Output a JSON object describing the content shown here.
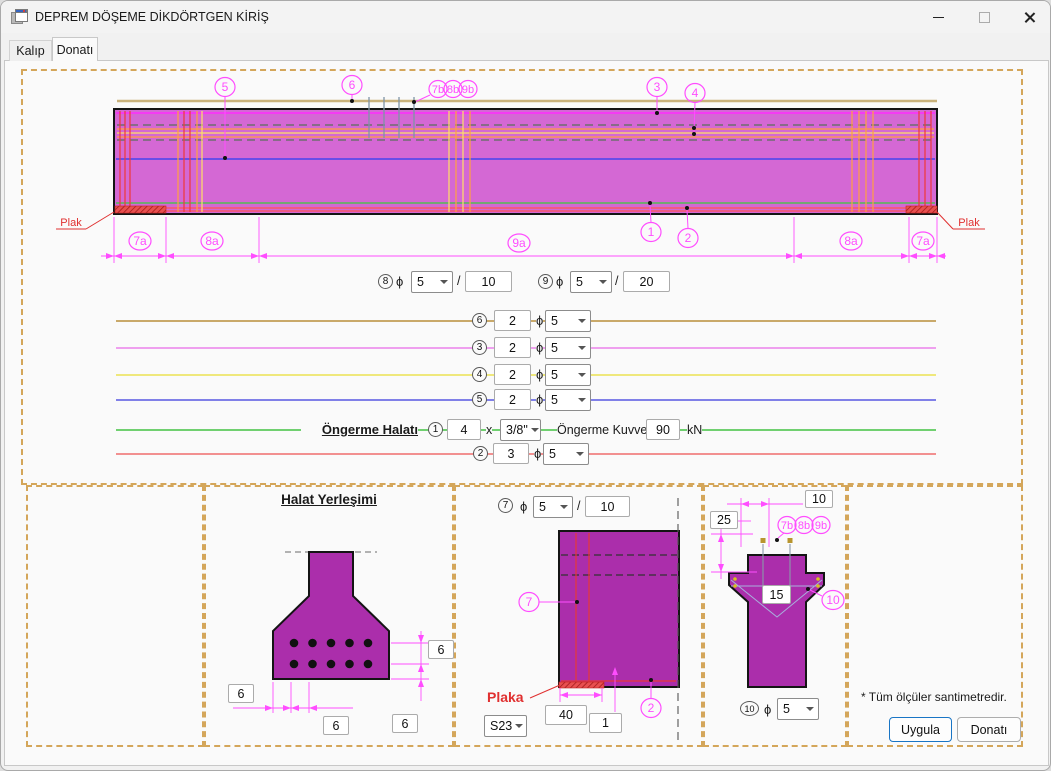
{
  "window": {
    "title": "DEPREM DÖŞEME DİKDÖRTGEN KİRİŞ"
  },
  "tabs": {
    "kalip": "Kalıp",
    "donati": "Donatı"
  },
  "misc": {
    "phi": "ϕ",
    "slash": "/",
    "times": "x"
  },
  "callouts": {
    "n1": "1",
    "n2": "2",
    "n3": "3",
    "n4": "4",
    "n5": "5",
    "n6": "6",
    "n7": "7",
    "n8": "8",
    "n9": "9",
    "n10": "10",
    "n7b": "7b",
    "n8b": "8b",
    "n9b": "9b",
    "d7a": "7a",
    "d8a": "8a",
    "d9a": "9a"
  },
  "beam": {
    "plak_left": "Plak",
    "plak_right": "Plak"
  },
  "rows": {
    "r8": {
      "dia": "5",
      "spacing": "10"
    },
    "r9": {
      "dia": "5",
      "spacing": "20"
    },
    "bars": [
      {
        "num": "6",
        "count": "2",
        "dia": "5",
        "color": "#C9A96A"
      },
      {
        "num": "3",
        "count": "2",
        "dia": "5",
        "color": "#EFA0EF"
      },
      {
        "num": "4",
        "count": "2",
        "dia": "5",
        "color": "#EFE87C"
      },
      {
        "num": "5",
        "count": "2",
        "dia": "5",
        "color": "#8080E8"
      }
    ],
    "tendon": {
      "label": "Öngerme Halatı",
      "count": "4",
      "size": "3/8\"",
      "force_label": "Öngerme Kuvveti :",
      "force": "90",
      "unit": "kN",
      "color": "#70D070"
    },
    "r2": {
      "count": "3",
      "dia": "5",
      "color": "#F29090"
    }
  },
  "halat": {
    "title": "Halat Yerleşimi",
    "dim_right_top": "6",
    "dim_right_bottom": "6",
    "dim_left": "6",
    "dim_bottom": "6"
  },
  "plaka": {
    "dia": "5",
    "spacing": "10",
    "label": "Plaka",
    "steel": "S23",
    "plate_width": "40",
    "plate_thickness": "1"
  },
  "section": {
    "dim_top": "10",
    "dim_side": "25",
    "dim_width": "15",
    "dia": "5"
  },
  "footer": {
    "note": "* Tüm ölçüler santimetredir.",
    "apply": "Uygula",
    "donati": "Donatı"
  },
  "colors": {
    "beam_fill": "#D468D4",
    "section_fill": "#AB2EAB",
    "magenta": "#FF4DFF",
    "panel_border": "#D4A65A",
    "plak_red": "#E03030"
  }
}
